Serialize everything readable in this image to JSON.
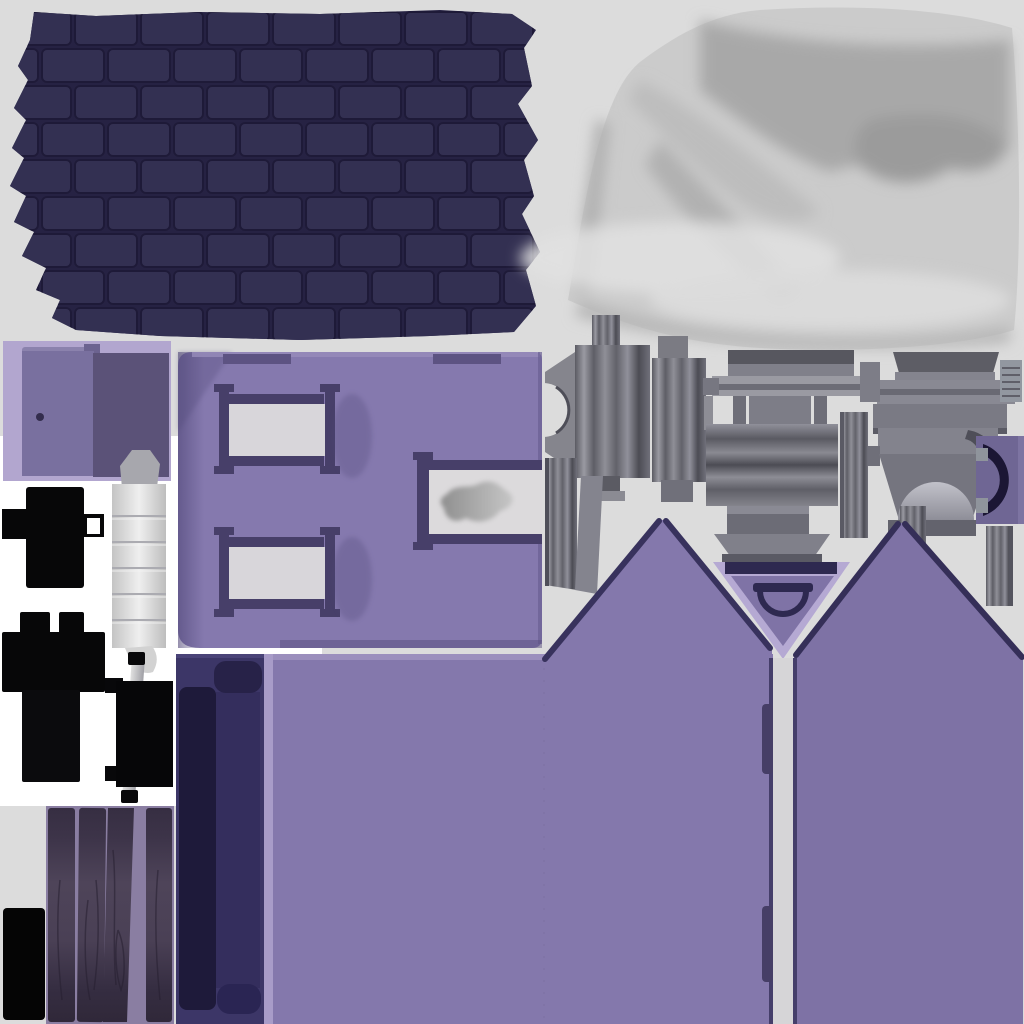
{
  "canvas": {
    "width": 1024,
    "height": 1024,
    "background": "#dcdcdc",
    "white_backdrop": "#ffffff"
  },
  "regions": {
    "roof_shingles": {
      "name": "roof-shingles-texture",
      "bbox": [
        8,
        8,
        537,
        332
      ],
      "colors": {
        "base": "#262243",
        "tile": "#333052",
        "stroke": "#1e1a38"
      }
    },
    "fabric": {
      "name": "fabric-texture",
      "bbox": [
        560,
        4,
        460,
        346
      ],
      "colors": {
        "base": "#cbcbcb",
        "shadow": "#a6a6a6",
        "deep": "#9b9b9b",
        "mid": "#b5b5b5",
        "highlight": "#e2e2e2"
      }
    },
    "door": {
      "name": "door-texture",
      "bbox": [
        3,
        341,
        168,
        140
      ],
      "colors": {
        "bg": "#b2a6cf",
        "left": "#79709f",
        "right": "#5b5278",
        "lip": "#8b82ad",
        "notch": "#6c6390",
        "knob": "#332d4d"
      }
    },
    "wall": {
      "name": "wall-with-windows-texture",
      "bbox": [
        176,
        352,
        366,
        296
      ],
      "colors": {
        "base": "#8579ae",
        "shadow": "#4f4677",
        "top_light": "#978cba",
        "notch": "#5d5382",
        "frame": "#473f69",
        "pane": "#d8d6da",
        "blob_dark": "#8f8f8f",
        "blob_light": "#c6c6c6",
        "edge": "#6a5f93"
      }
    },
    "black_parts": {
      "name": "black-silhouette-parts",
      "bbox": [
        2,
        487,
        103,
        295
      ],
      "colors": {
        "fill": "#070708",
        "hole": "#ffffff"
      }
    },
    "cylinder": {
      "name": "cylinder-hinge-part",
      "bbox": [
        104,
        450,
        72,
        228
      ],
      "colors": {
        "light": "#efefef",
        "dark": "#c4c4c4",
        "cap": "#a7a7ad",
        "ridge": "#ababb1"
      }
    },
    "hinge": {
      "name": "hinge-bracket-part",
      "bbox": [
        103,
        652,
        75,
        153
      ],
      "colors": {
        "rod_light": "#e0e0e0",
        "rod_dark": "#9f9fa5",
        "black": "#08080a"
      }
    },
    "bed": {
      "name": "dark-navy-panel",
      "bbox": [
        176,
        654,
        88,
        370
      ],
      "colors": {
        "base": "#3c3667",
        "pillow": "#272248",
        "inner": "#1e1a3a",
        "mid": "#332d5c",
        "blob": "#2a2553"
      }
    },
    "lower_purple": {
      "name": "lower-wall-purple",
      "bbox": [
        264,
        654,
        509,
        370
      ],
      "colors": {
        "base": "#8478ac",
        "highlight": "#a89cc8",
        "top_light": "#9d91bf"
      }
    },
    "gables": {
      "name": "gable-walls",
      "bbox": [
        543,
        519,
        480,
        505
      ],
      "colors": {
        "left": "#8478ac",
        "right": "#7e72a5",
        "edge": "#38325d"
      }
    },
    "collar": {
      "name": "collar-v-triangle",
      "bbox": [
        713,
        562,
        137,
        97
      ],
      "colors": {
        "light": "#b5a9d3",
        "inner": "#7f73a6",
        "dark": "#2e2950"
      }
    },
    "door_gap": {
      "name": "door-gap-strip",
      "bbox": [
        769,
        658,
        28,
        366
      ],
      "colors": {
        "strip": "#d6d5d7",
        "edge": "#453e6a",
        "handle": "#463e66"
      }
    },
    "metal": {
      "name": "gray-hardware-parts",
      "bbox": [
        540,
        314,
        484,
        292
      ],
      "colors": {
        "light": "#9a9aa2",
        "mid": "#85858d",
        "dark": "#5b5b63",
        "deep": "#4c4c54",
        "panel": "#7d7d87"
      }
    },
    "c_handle": {
      "name": "c-handle-part",
      "bbox": [
        976,
        436,
        48,
        88
      ],
      "colors": {
        "bg": "#6f6694",
        "arc": "#1b1634",
        "notch": "#8f949c"
      }
    },
    "dome": {
      "name": "dome-vent-part",
      "bbox": [
        864,
        428,
        134,
        110
      ],
      "colors": {
        "light": "#c2c2ca",
        "dark": "#8e8e98"
      }
    },
    "wood_planks": {
      "name": "wood-planks-texture",
      "bbox": [
        46,
        806,
        128,
        218
      ],
      "colors": {
        "bg": "#8a7ea2",
        "top": "#362e42",
        "mid": "#4e4459",
        "bottom": "#302839",
        "grain": "#261f30"
      }
    },
    "black_square": {
      "name": "black-square-part",
      "bbox": [
        3,
        908,
        42,
        112
      ],
      "colors": {
        "fill": "#050505"
      }
    }
  }
}
